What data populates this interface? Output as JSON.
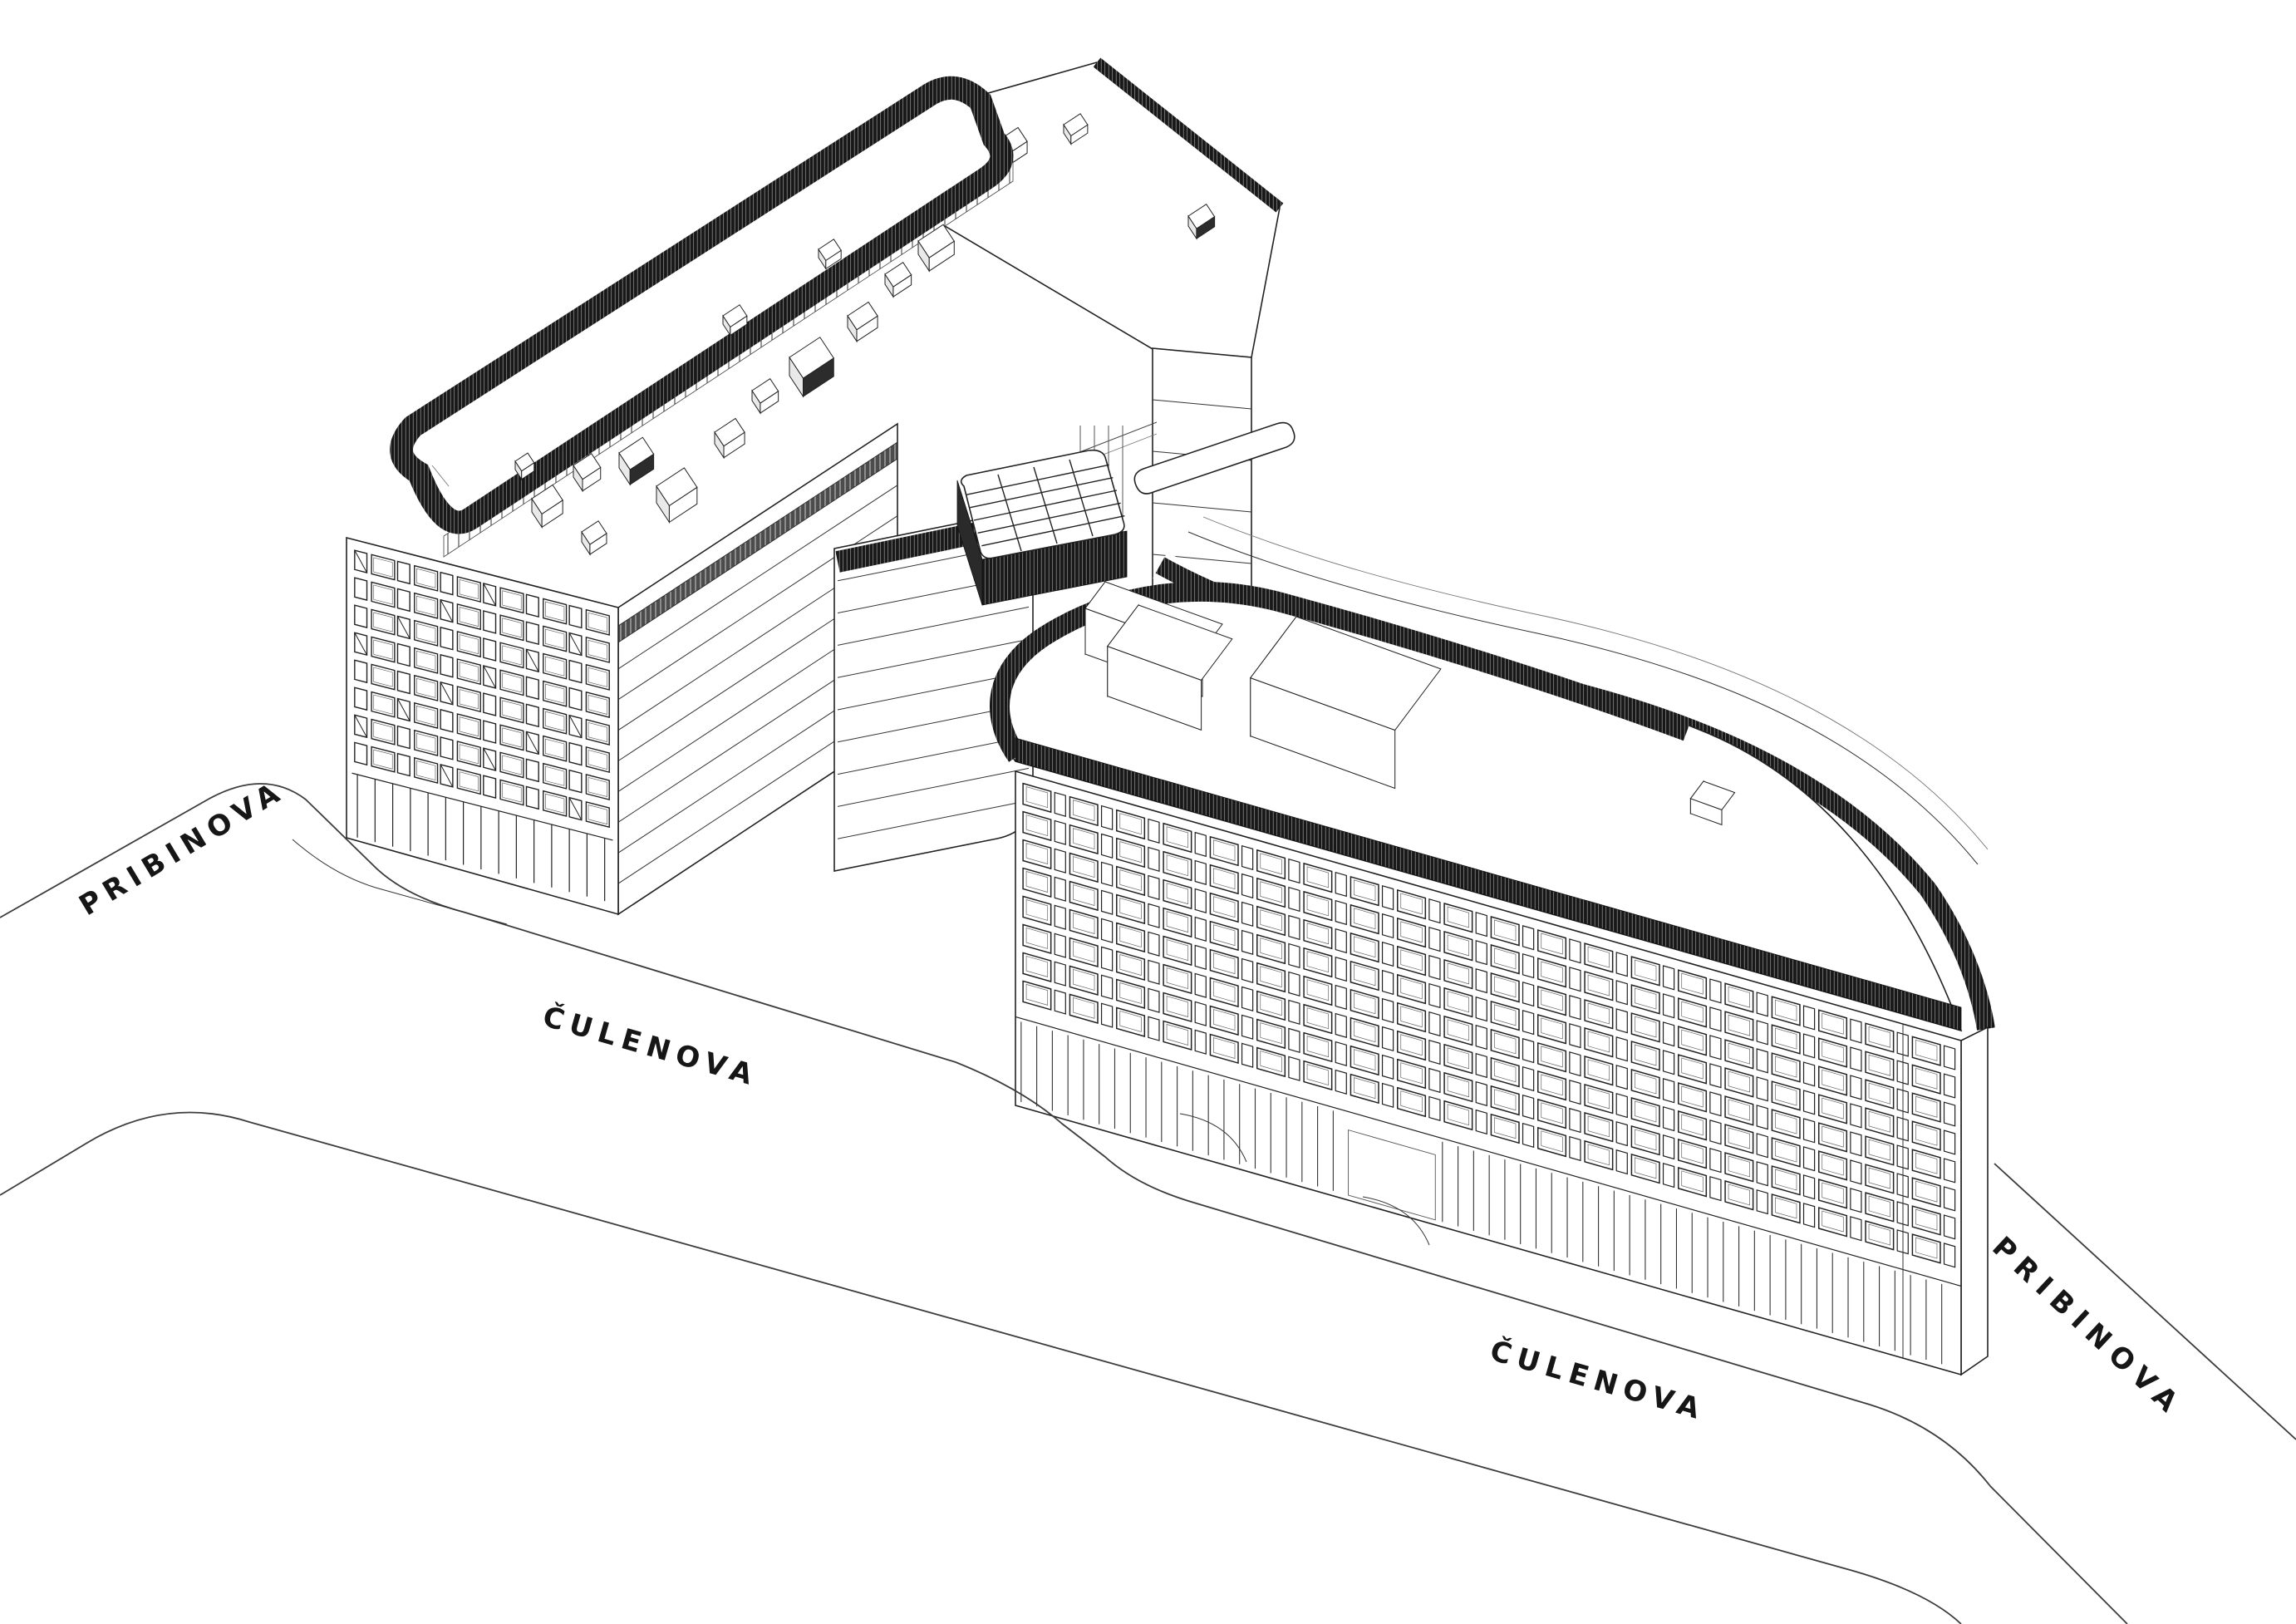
{
  "drawing": {
    "type": "axonometric-architectural-line-drawing",
    "subject": "office building complex with rooftop equipment, courtyard skylight and surrounding streets",
    "street_labels": [
      {
        "id": "pribinova-left",
        "text": "PRIBINOVA"
      },
      {
        "id": "culenova-left",
        "text": "ČULENOVA"
      },
      {
        "id": "culenova-bottom",
        "text": "ČULENOVA"
      },
      {
        "id": "pribinova-right",
        "text": "PRIBINOVA"
      }
    ],
    "colors": {
      "background": "#ffffff",
      "line": "#222222",
      "dark_louver_band": "#181818",
      "label_text": "#161616"
    }
  }
}
